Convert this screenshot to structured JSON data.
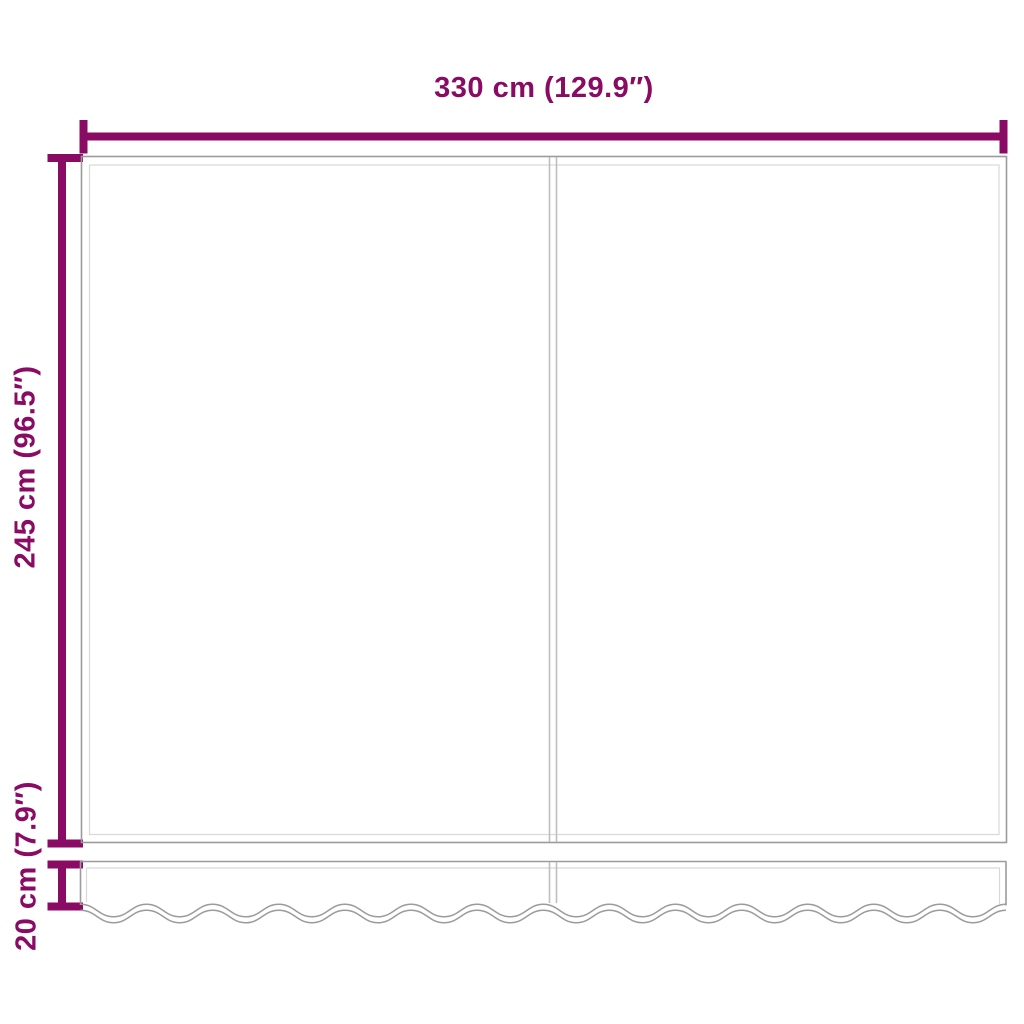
{
  "diagram": {
    "width_label": "330 cm (129.9″)",
    "height_label": "245 cm (96.5″)",
    "valance_label": "20 cm (7.9″)",
    "colors": {
      "dimension_accent": "#8A0B63",
      "panel_outline": "#9B9B9B",
      "panel_inner_line": "#D8D8D8",
      "seam_line": "#BEBEBE",
      "background": "#FFFFFF"
    }
  }
}
